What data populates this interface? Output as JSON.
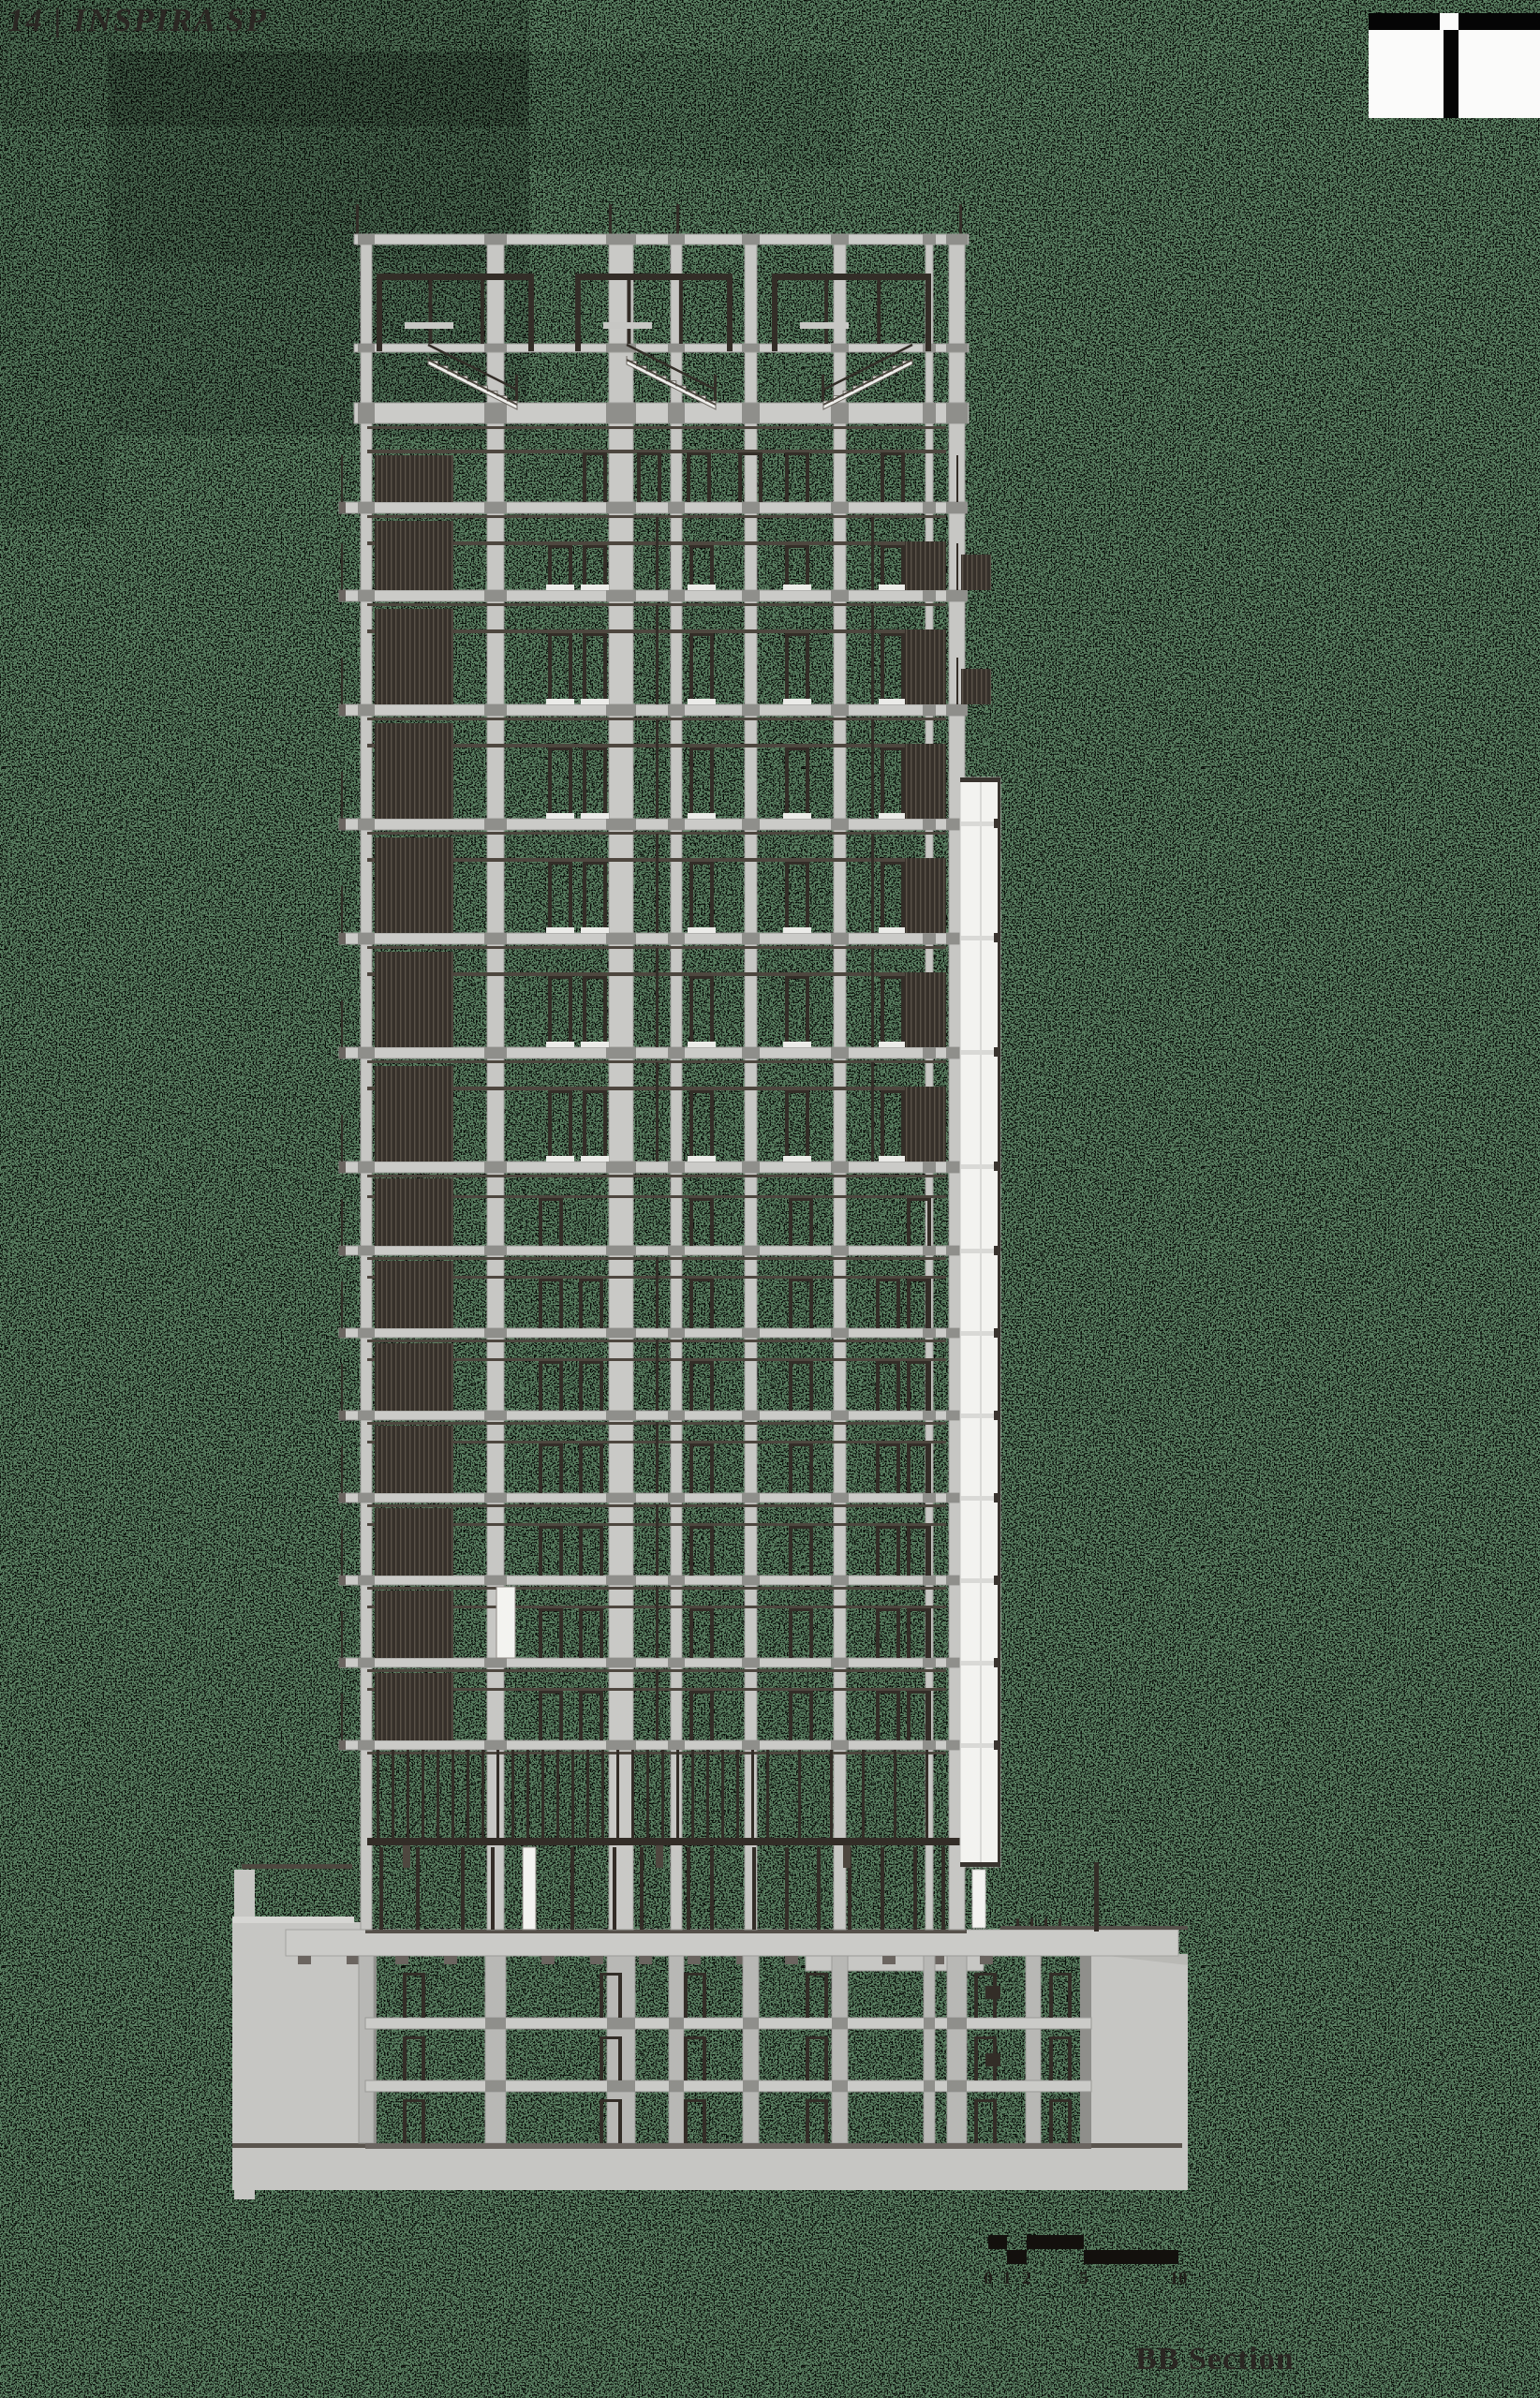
{
  "header": {
    "page_label": "14 | INSPIRA SP"
  },
  "figure": {
    "caption": "BB Section"
  },
  "scale_bar": {
    "labels": [
      "0",
      "1",
      "2",
      "5",
      "10"
    ]
  },
  "colors": {
    "background_green": "#5b8062",
    "noise_black": "#000000",
    "concrete_light": "#cbcbc8",
    "concrete_mid": "#c7c7c4",
    "concrete_core": "#c9c9c6",
    "concrete_edge": "#9a9a96",
    "joint_gray": "#8f8f8b",
    "dark_frame": "#332d27",
    "dark_line": "#4e473f",
    "louver_dark": "#36302a",
    "louver_light": "#5a5248",
    "white_element": "#f3f3f0",
    "shaft_line": "#d9d9d6",
    "earth_gray": "#c6c6c3",
    "text_dark": "#2b2723"
  }
}
